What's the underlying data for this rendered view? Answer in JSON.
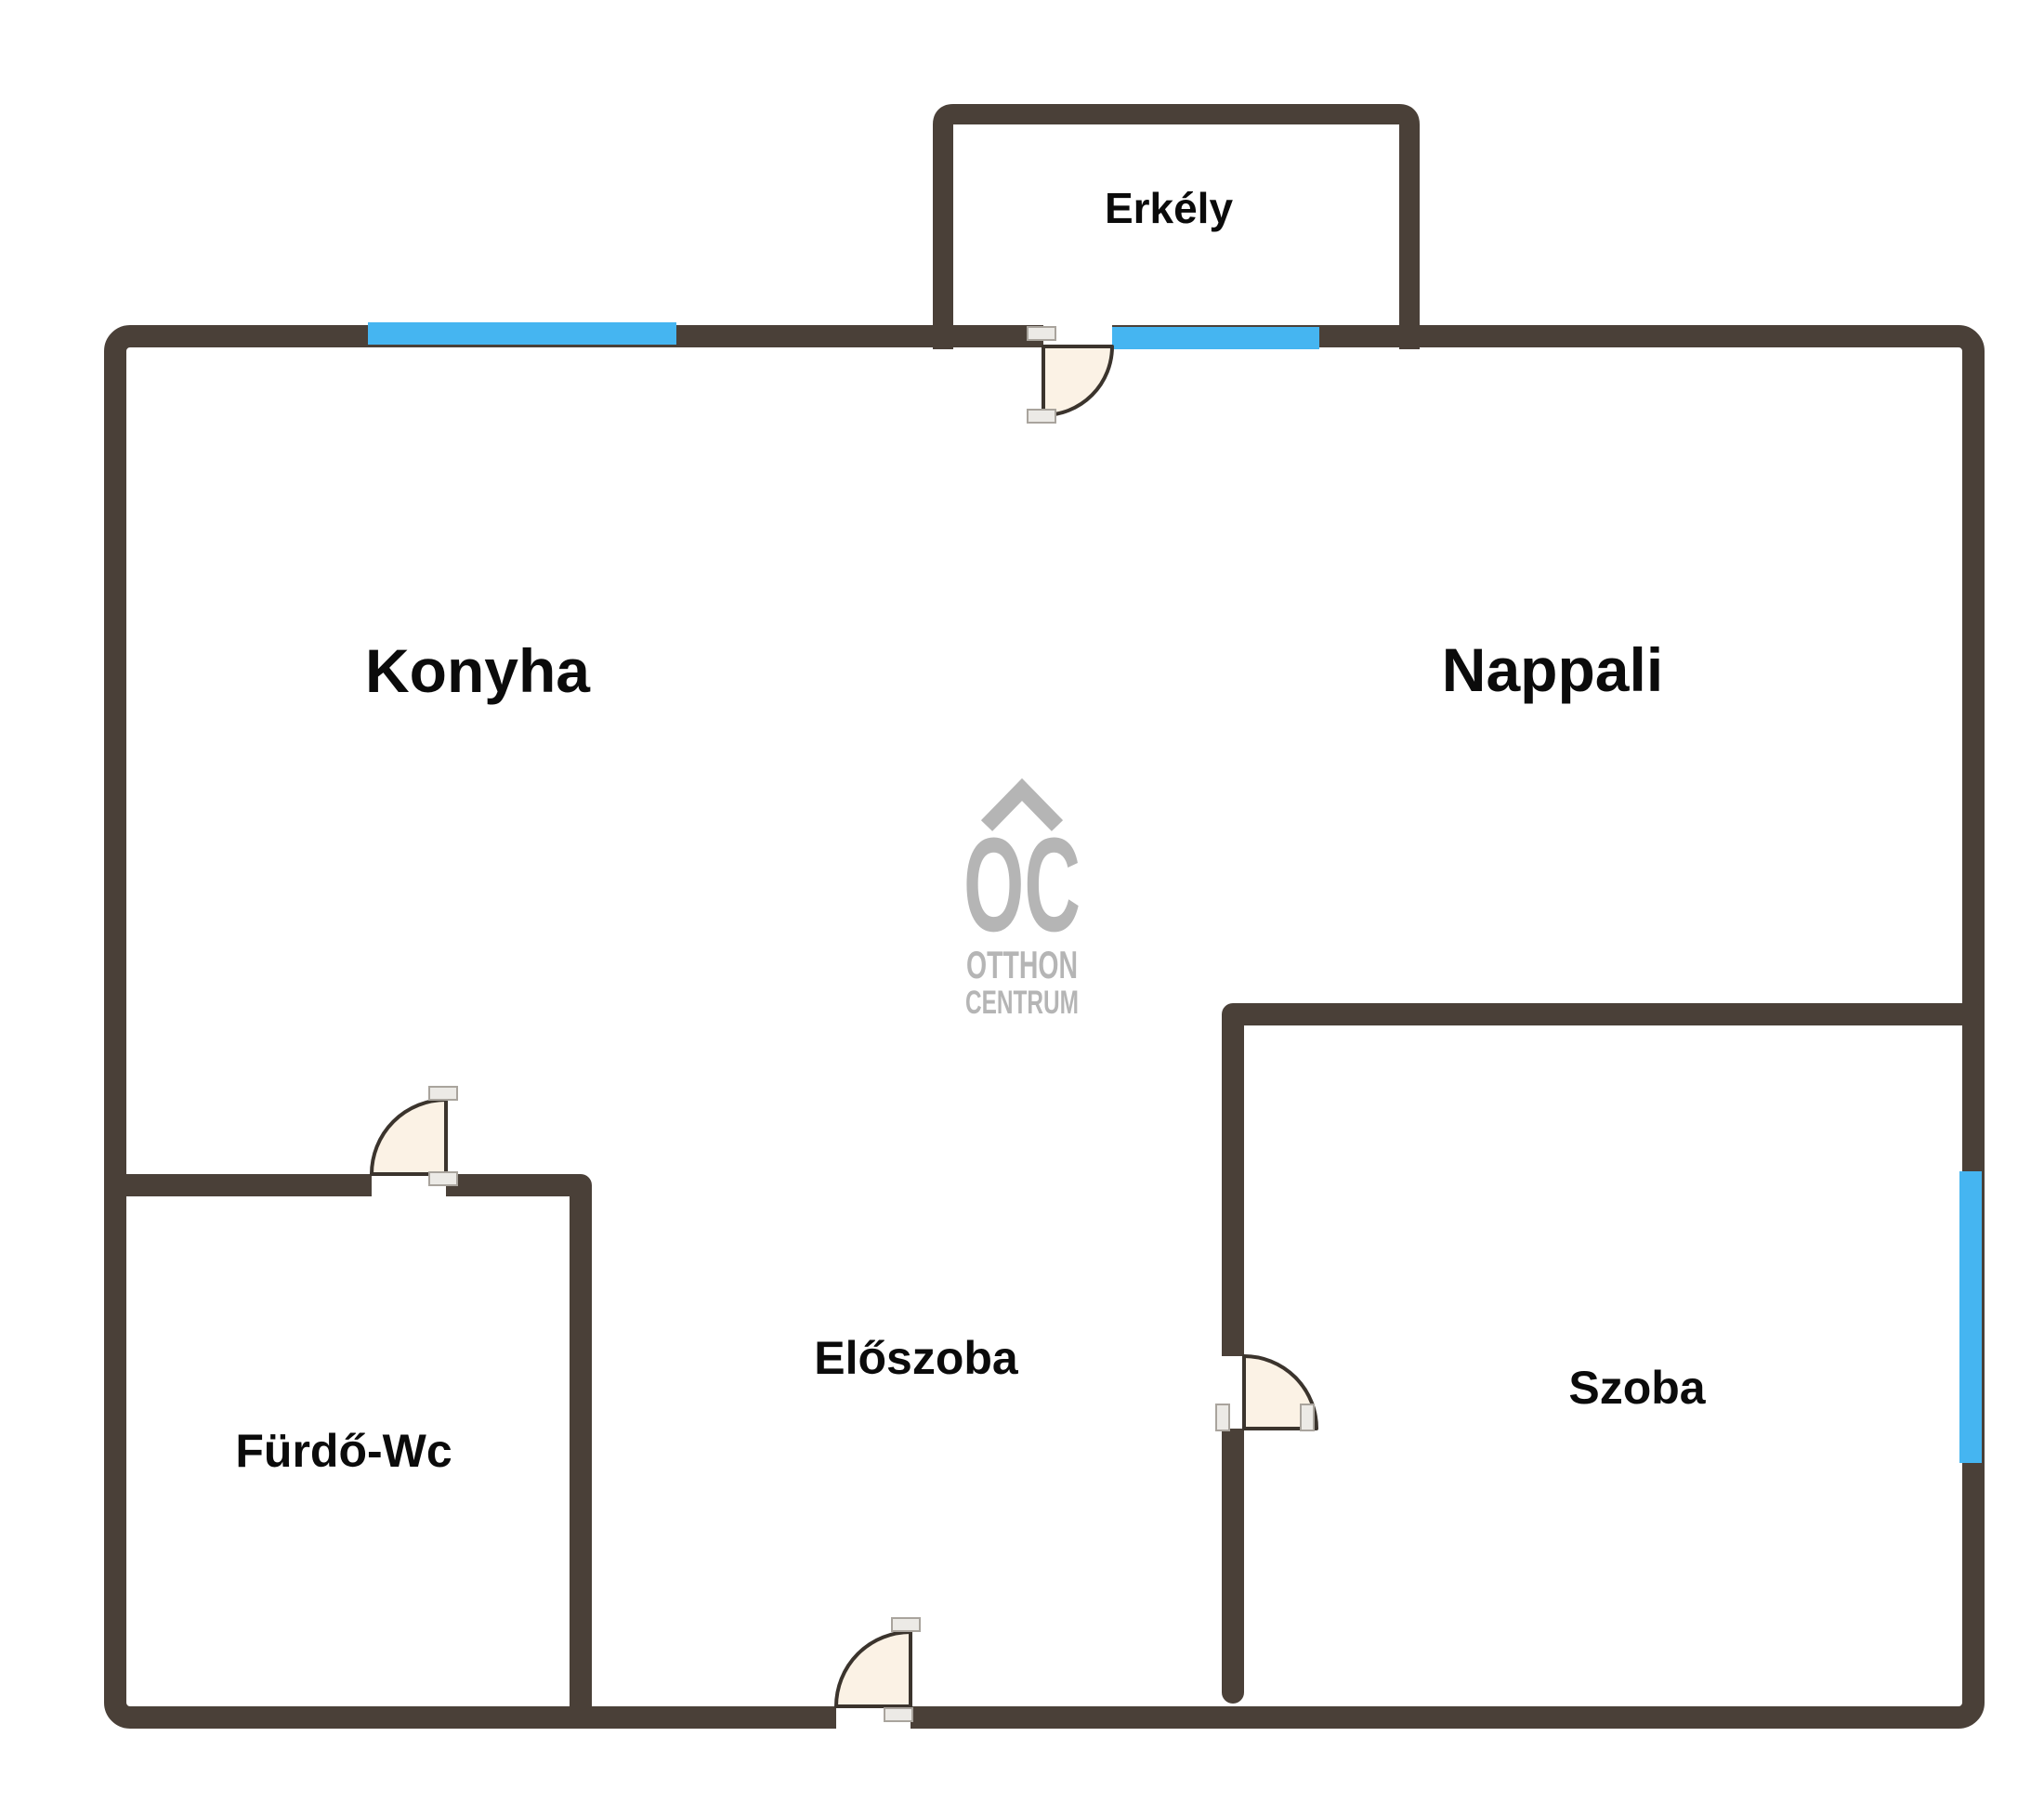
{
  "floorplan": {
    "labels": {
      "erkely": "Erkély",
      "konyha": "Konyha",
      "nappali": "Nappali",
      "eloszoba": "Előszoba",
      "furdo_wc": "Fürdő-Wc",
      "szoba": "Szoba"
    },
    "watermark": {
      "monogram": "OC",
      "line1": "OTTHON",
      "line2": "CENTRUM"
    },
    "colors": {
      "wall": "#4A4038",
      "window": "#45B5F1",
      "door_fill": "#FBF2E5",
      "door_stroke": "#3B342D",
      "jamb_fill": "#ECEAE6",
      "jamb_stroke": "#A9A49D",
      "label": "#0B0B0B",
      "watermark": "#B5B5B5",
      "background": "#FFFFFF"
    }
  }
}
